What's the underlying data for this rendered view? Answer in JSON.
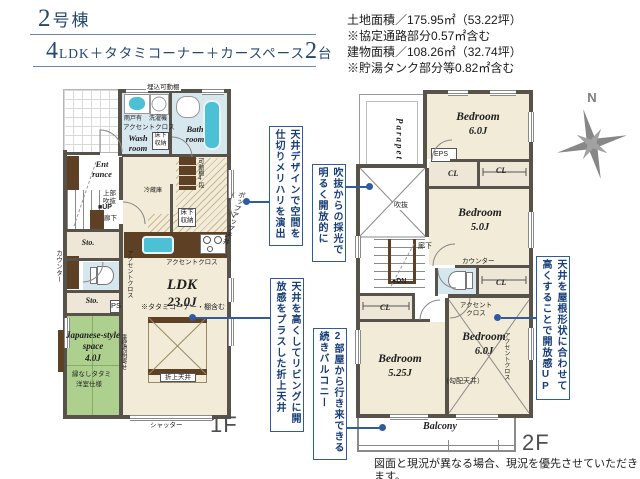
{
  "colors": {
    "accent_blue": "#2e5c9e",
    "callout_text": "#173c78",
    "title_navy": "#24486e",
    "wall": "#57534b",
    "floor_beige": "#f1ebd7",
    "storage_beige": "#eee6d6",
    "water_blue": "#d7e7ee",
    "tub_cyan": "#4cc0d5",
    "tatami_green": "#aed08e",
    "wood_brown": "#5e4124"
  },
  "header": {
    "building_num": "2",
    "building_suffix": "号棟",
    "plan_num1": "4",
    "plan_mid": "LDK＋タタミコーナー＋カースペース",
    "plan_num2": "2",
    "plan_suffix": "台"
  },
  "site_info": {
    "line1": "土地面積／175.95㎡（53.22坪）",
    "line2": "※協定通路部分0.57㎡含む",
    "line3": "建物面積／108.26㎡（32.74坪）",
    "line4": "※貯湯タンク部分等0.82㎡含む"
  },
  "compass_label": "N",
  "floor1": {
    "floor_label": "1F",
    "rooms": {
      "bath": "Bath room",
      "wash": "Wash room",
      "entrance": "Ent rance",
      "sto1": "Sto.",
      "sto2": "Sto.",
      "jroom_name": "Japanese-style space",
      "jroom_size": "4.0J",
      "ldk_name": "LDK",
      "ldk_size": "23.0J"
    },
    "labels": {
      "umekomi": "埋込可動棚",
      "washer": "洗濯機",
      "amado": "雨戸有",
      "accent_wash": "アクセントクロス",
      "yukashita_wash": "床下収納",
      "joubu": "上部吹抜",
      "up": "■UP",
      "rouka": "廊下",
      "counter": "カウンター",
      "ps": "PS",
      "tatami_note1": "縁なしタタミ",
      "tatami_note2": "洋室仕様",
      "tarekabe": "垂壁照明寄せ",
      "pantry": "可動棚4段",
      "fridge": "冷蔵庫",
      "yukashita_k": "床下収納",
      "accent_k": "アクセントクロス",
      "accent_wall": "アクセントクロス",
      "popup": "ポップアップ天井",
      "tatami_inc": "※タタミコーナー・棚含む",
      "oriage": "折上天井",
      "shutter": "シャッター"
    }
  },
  "floor2": {
    "floor_label": "2F",
    "rooms": {
      "bed_top_name": "Bedroom",
      "bed_top_size": "6.0J",
      "bed_mid_name": "Bedroom",
      "bed_mid_size": "5.0J",
      "bed_br_name": "Bedroom",
      "bed_br_size": "6.0J",
      "bed_bl_name": "Bedroom",
      "bed_bl_size": "5.25J",
      "balcony": "Balcony",
      "parapet": "Parapet"
    },
    "labels": {
      "eps": "EPS",
      "cl1": "CL",
      "cl2": "CL",
      "cl3": "CL",
      "cl4": "CL",
      "fukinuke": "吹抜",
      "rouka": "廊下",
      "counter": "カウンター",
      "dn": "●DN",
      "accent1": "アクセントクロス",
      "accent2": "アクセントクロス",
      "kobai": "（勾配天井）"
    }
  },
  "callouts": {
    "c1": "天井デザインで空間を仕切りメリハリを演出",
    "c2": "吹抜からの採光で明るく開放的に",
    "c3": "天井を高くしてリビングに開放感をプラスした折上天井",
    "c4": "2部屋から行き来できる続きバルコニー",
    "c5": "天井を屋根形状に合わせて高くすることで開放感UP"
  },
  "footer": {
    "disclaimer": "図面と現況が異なる場合、現況を優先させていただきます。"
  }
}
